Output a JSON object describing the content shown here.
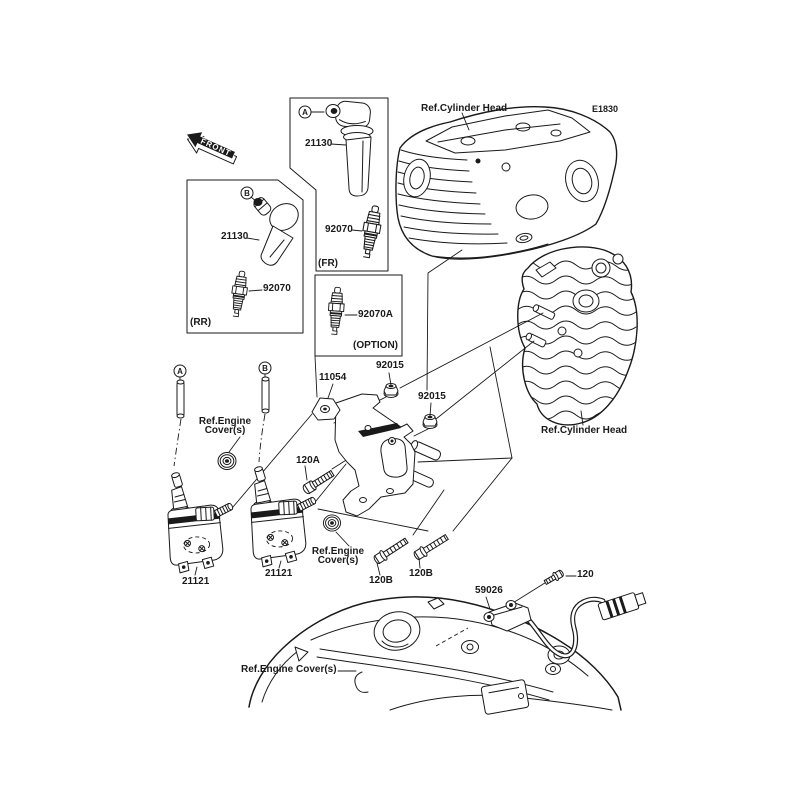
{
  "colors": {
    "background": "#ffffff",
    "line": "#1a1a1a"
  },
  "front_marker": "FRONT",
  "page_code": "E1830",
  "callouts": {
    "front_cap": "A",
    "rear_cap": "B",
    "front_coil": "A",
    "rear_coil": "B"
  },
  "boxes": {
    "fr": {
      "caption": "(FR)",
      "cap_part": "21130",
      "plug_part": "92070"
    },
    "rr": {
      "caption": "(RR)",
      "cap_part": "21130",
      "plug_part": "92070"
    },
    "option": {
      "caption": "(OPTION)",
      "plug_part": "92070A"
    }
  },
  "refs": {
    "cylinder_head_front": "Ref.Cylinder Head",
    "cylinder_head_rear": "Ref.Cylinder Head",
    "engine_cover_upper": "Ref.Engine\nCover(s)",
    "engine_cover_mid": "Ref.Engine\nCover(s)",
    "engine_cover_bottom": "Ref.Engine Cover(s)"
  },
  "parts": {
    "bracket": "11054",
    "nut_upper": "92015",
    "nut_lower": "92015",
    "bolt_coil": "120A",
    "bolt_bracket_left": "120B",
    "bolt_bracket_right": "120B",
    "bolt_sensor": "120",
    "coil_front": "21121",
    "coil_rear": "21121",
    "sensor": "59026"
  }
}
